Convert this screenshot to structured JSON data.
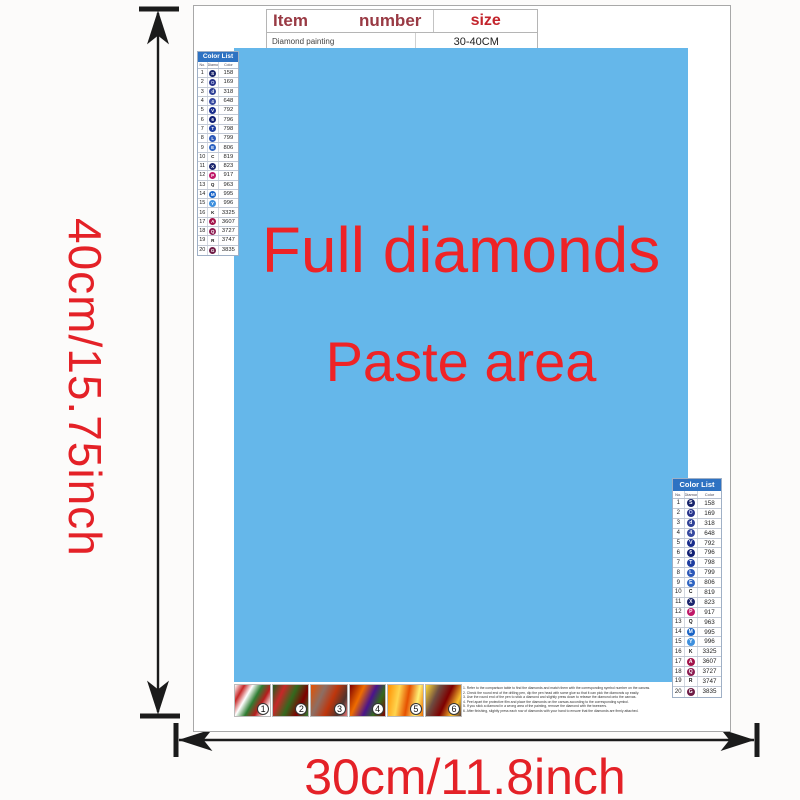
{
  "dimensions": {
    "height_label": "40cm/15.75inch",
    "width_label": "30cm/11.8inch"
  },
  "item_table": {
    "header_item": "Item",
    "header_number": "number",
    "header_size": "size",
    "row_name": "Diamond painting",
    "row_size": "30-40CM"
  },
  "paste_area": {
    "line1": "Full diamonds",
    "line2": "Paste area",
    "bg_color": "#65b7ea",
    "text_color": "#ee2326"
  },
  "color_list": {
    "title": "Color List",
    "col_no": "No.",
    "col_symbol": "Diamond",
    "col_color": "Color",
    "rows": [
      {
        "no": "1",
        "symbol": "S",
        "bg": "#16236a",
        "fg": "#ffffff",
        "code": "158"
      },
      {
        "no": "2",
        "symbol": "O",
        "bg": "#27338a",
        "fg": "#ccd4f5",
        "code": "169"
      },
      {
        "no": "3",
        "symbol": "d",
        "bg": "#2e4096",
        "fg": "#ffffff",
        "code": "318"
      },
      {
        "no": "4",
        "symbol": "4",
        "bg": "#35489f",
        "fg": "#ffffff",
        "code": "648"
      },
      {
        "no": "5",
        "symbol": "V",
        "bg": "#182c8c",
        "fg": "#ffffff",
        "code": "792"
      },
      {
        "no": "6",
        "symbol": "6",
        "bg": "#101f74",
        "fg": "#ffffff",
        "code": "796"
      },
      {
        "no": "7",
        "symbol": "T",
        "bg": "#1e3da0",
        "fg": "#ffffff",
        "code": "798"
      },
      {
        "no": "8",
        "symbol": "L",
        "bg": "#2b57b8",
        "fg": "#ffffff",
        "code": "799"
      },
      {
        "no": "9",
        "symbol": "E",
        "bg": "#2e64c2",
        "fg": "#ffffff",
        "code": "806"
      },
      {
        "no": "10",
        "symbol": "C",
        "bg": "transparent",
        "fg": "#111111",
        "code": "819"
      },
      {
        "no": "11",
        "symbol": "X",
        "bg": "#1a256e",
        "fg": "#ffffff",
        "code": "823"
      },
      {
        "no": "12",
        "symbol": "P",
        "bg": "#c01868",
        "fg": "#ffffff",
        "code": "917"
      },
      {
        "no": "13",
        "symbol": "Q",
        "bg": "transparent",
        "fg": "#111111",
        "code": "963"
      },
      {
        "no": "14",
        "symbol": "M",
        "bg": "#1863c6",
        "fg": "#ffffff",
        "code": "995"
      },
      {
        "no": "15",
        "symbol": "Y",
        "bg": "#3e90de",
        "fg": "#ffffff",
        "code": "996"
      },
      {
        "no": "16",
        "symbol": "K",
        "bg": "transparent",
        "fg": "#111111",
        "code": "3325"
      },
      {
        "no": "17",
        "symbol": "A",
        "bg": "#a3134a",
        "fg": "#ffffff",
        "code": "3607"
      },
      {
        "no": "18",
        "symbol": "Q",
        "bg": "#8c1d52",
        "fg": "#ffffff",
        "code": "3727"
      },
      {
        "no": "19",
        "symbol": "R",
        "bg": "transparent",
        "fg": "#111111",
        "code": "3747"
      },
      {
        "no": "20",
        "symbol": "G",
        "bg": "#6f1c46",
        "fg": "#ffffff",
        "code": "3835"
      }
    ]
  },
  "thumbnails": {
    "items": [
      {
        "number": "1",
        "gradient": "linear-gradient(120deg,#ffffff 0%,#c62828 18%,#ffffff 34%,#2e7d32 52%,#b71c1c 70%,#ffffff 88%)"
      },
      {
        "number": "2",
        "gradient": "linear-gradient(115deg,#1b5e20 0%,#c62828 25%,#33691e 50%,#7f0000 75%,#2e7d32 100%)"
      },
      {
        "number": "3",
        "gradient": "linear-gradient(115deg,#e65100 0%,#8d6e63 30%,#bf360c 55%,#4e342e 80%,#e57373 100%)"
      },
      {
        "number": "4",
        "gradient": "linear-gradient(115deg,#7f0000 0%,#ef6c00 30%,#4a148c 55%,#33691e 75%,#7f0000 100%)"
      },
      {
        "number": "5",
        "gradient": "linear-gradient(100deg,#ff8f00 0%,#ffd54f 30%,#e65100 55%,#fff176 80%,#ef6c00 100%)"
      },
      {
        "number": "6",
        "gradient": "linear-gradient(115deg,#fdd835 0%,#6d4c41 30%,#7f0000 55%,#fbc02d 80%,#5d4037 100%)"
      }
    ]
  },
  "instructions": {
    "lines": [
      {
        "text": "1. Refer to the comparison table to find the diamonds and match them with the corresponding symbol number on the canvas."
      },
      {
        "text": "2. Check the round end of the drilling pen, dip the pen head with some glue so that it can pick the diamonds up easily."
      },
      {
        "text": "3. Use the round end of the pen to stick a diamond and slightly press down to release the diamond onto the canvas."
      },
      {
        "text": "4. Peel apart the protective film and place the diamonds on the canvas according to the corresponding symbol."
      },
      {
        "text": "5. If you stick a diamond in a wrong area of the painting, remove the diamond with the tweezers."
      },
      {
        "text": "6. After finishing, slightly press each row of diamonds with your hand to ensure that the diamonds are firmly attached."
      }
    ]
  }
}
